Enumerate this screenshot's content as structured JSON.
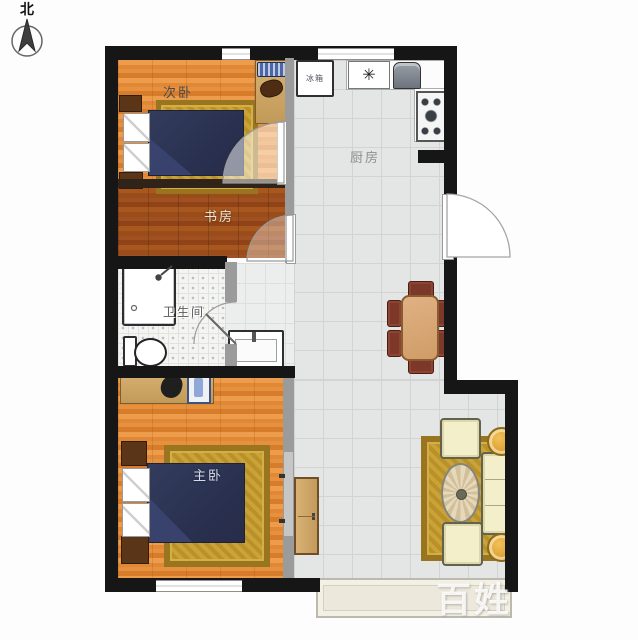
{
  "compass": {
    "label": "北"
  },
  "rooms": {
    "secondary_bedroom": {
      "label": "次卧"
    },
    "study": {
      "label": "书房"
    },
    "bathroom": {
      "label": "卫生间"
    },
    "kitchen": {
      "label": "厨房"
    },
    "master_bedroom": {
      "label": "主卧"
    }
  },
  "kitchen_items": {
    "fridge_label": "冰箱",
    "hob_symbol": "✳"
  },
  "watermark": {
    "text": "百姓"
  },
  "colors": {
    "wall": "#161616",
    "interior_wall_gray": "#9b9b9b",
    "wood_floor": "#e08836",
    "study_floor": "#9a4c1a",
    "tile_floor": "#e4e5e5",
    "bed_blanket_navy": "#2a3150",
    "rug_gold": "#c9a338",
    "sofa_cream": "#f2efca",
    "dining_chair_brown": "#7c392a",
    "desk_tan": "#c29a58"
  }
}
